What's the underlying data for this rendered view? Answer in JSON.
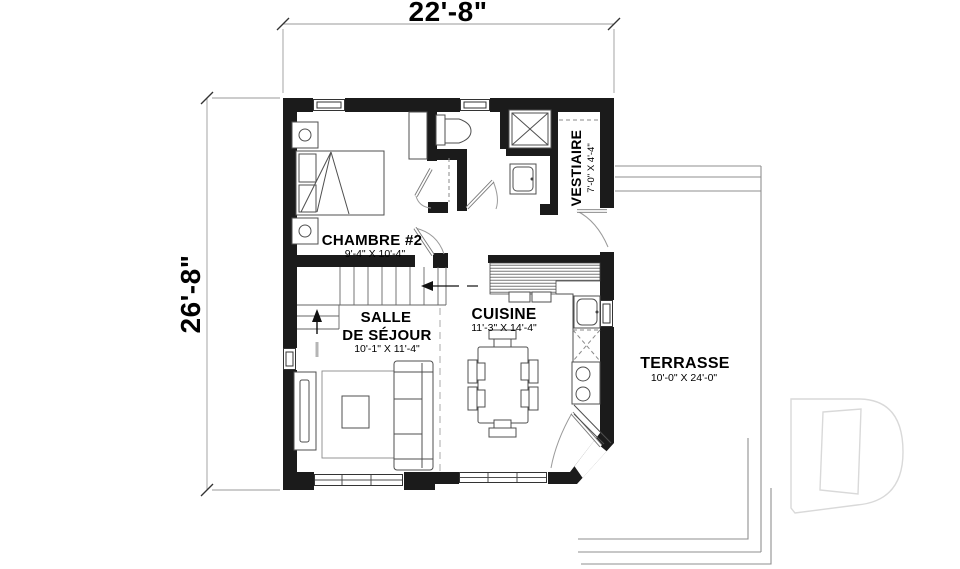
{
  "plan": {
    "title": "floor-plan",
    "dim_width": "22'-8\"",
    "dim_height": "26'-8\"",
    "rooms": {
      "chambre": {
        "name": "CHAMBRE #2",
        "size": "9'-4\" X 10'-4\""
      },
      "vestiaire": {
        "name": "VESTIAIRE",
        "size": "7'-0\" X 4'-4\""
      },
      "sejour": {
        "name_line1": "SALLE",
        "name_line2": "DE SÉJOUR",
        "size": "10'-1\" X 11'-4\""
      },
      "cuisine": {
        "name": "CUISINE",
        "size": "11'-3\" X 14'-4\""
      },
      "terrasse": {
        "name": "TERRASSE",
        "size": "10'-0\" X 24'-0\""
      }
    },
    "watermark_letter": "D",
    "colors": {
      "wall": "#1b1b1b",
      "line": "#4f4f4f",
      "terrace": "#8f8f8f",
      "watermark": "#d9d9d9"
    }
  }
}
